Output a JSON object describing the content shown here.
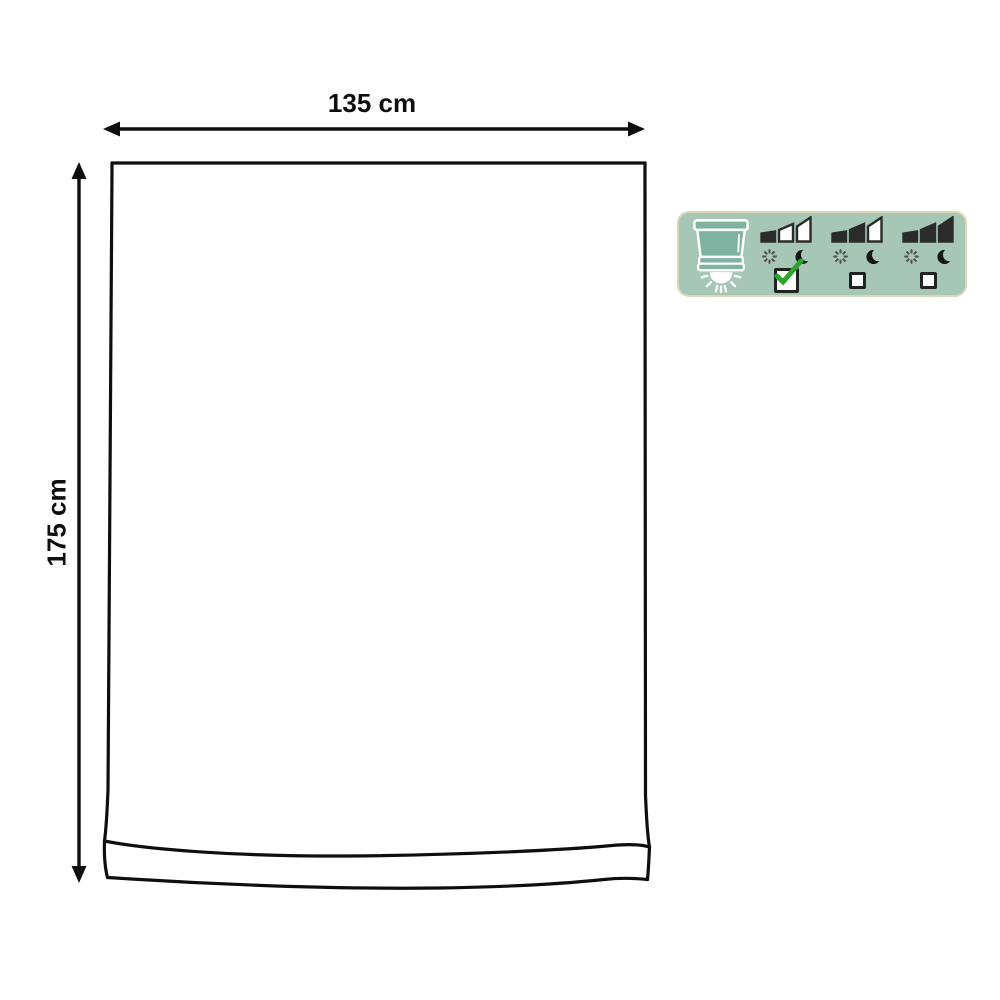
{
  "diagram": {
    "width_label": "135 cm",
    "height_label": "175 cm",
    "line_color": "#0e0e0e"
  },
  "badge": {
    "bg_color": "#a6c7b5",
    "border_color": "#ded6b8",
    "blind_fill_color": "#7fb2a0",
    "blind_stroke_color": "#ffffff",
    "bar_dark_color": "#2b2b2b",
    "bar_light_color": "#ffffff",
    "sun_color": "#4d4d4d",
    "moon_color": "#161616",
    "checkbox_border_color": "#222222",
    "check_color": "#2ba62b",
    "options": [
      {
        "name": "light-level-1",
        "bars_filled": 1,
        "checked": true
      },
      {
        "name": "light-level-2",
        "bars_filled": 2,
        "checked": false
      },
      {
        "name": "light-level-3",
        "bars_filled": 3,
        "checked": false
      }
    ]
  }
}
